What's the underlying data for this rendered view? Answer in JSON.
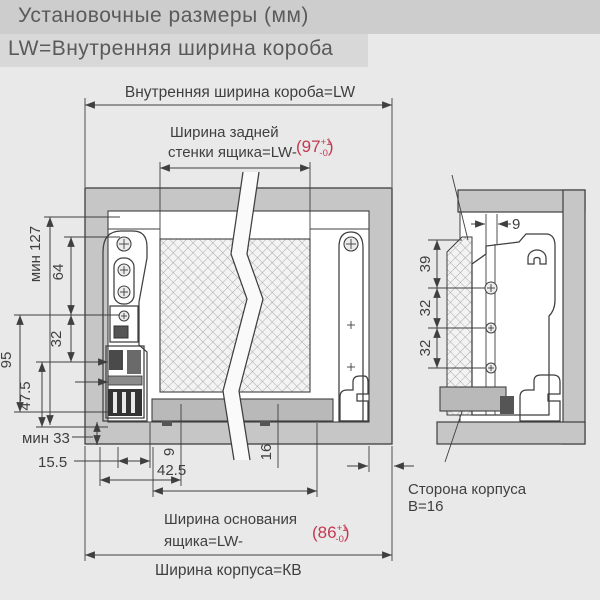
{
  "header": {
    "title": "Установочные размеры (мм)",
    "subtitle": "LW=Внутренняя ширина короба"
  },
  "main_view": {
    "top_dim_label": "Внутренняя ширина короба=LW",
    "back_width_label_1": "Ширина задней",
    "back_width_label_2": "стенки ящика=LW-",
    "back_width_tol": {
      "open": "(97",
      "plus": "+1",
      "minus": "-0",
      "close": ")"
    },
    "left_dims": {
      "min_127": "мин 127",
      "d64": "64",
      "d95": "95",
      "d32": "32",
      "d47_5": "47.5",
      "min_33": "мин 33",
      "d15_5": "15.5"
    },
    "bottom_dims": {
      "d42_5": "42.5",
      "d9": "9",
      "d16": "16"
    },
    "base_width_label_1": "Ширина основания",
    "base_width_label_2": "ящика=LW-",
    "base_width_tol": {
      "open": "(86",
      "plus": "+1",
      "minus": "-0",
      "close": ")"
    },
    "cabinet_width_label": "Ширина корпуса=КВ",
    "side_label_1": "Сторона корпуса",
    "side_label_2": "B=16"
  },
  "detail_view": {
    "d9": "9",
    "d39": "39",
    "d32_top": "32",
    "d32_bottom": "32"
  },
  "colors": {
    "background": "#e9e9e9",
    "header_bar_1": "#cdcdcd",
    "header_bar_2": "#d8d8d8",
    "wall_gray": "#c6c6c6",
    "panel_gray": "#b9b9b9",
    "line": "#3f3f3f",
    "tolerance_red": "#c13a52"
  }
}
